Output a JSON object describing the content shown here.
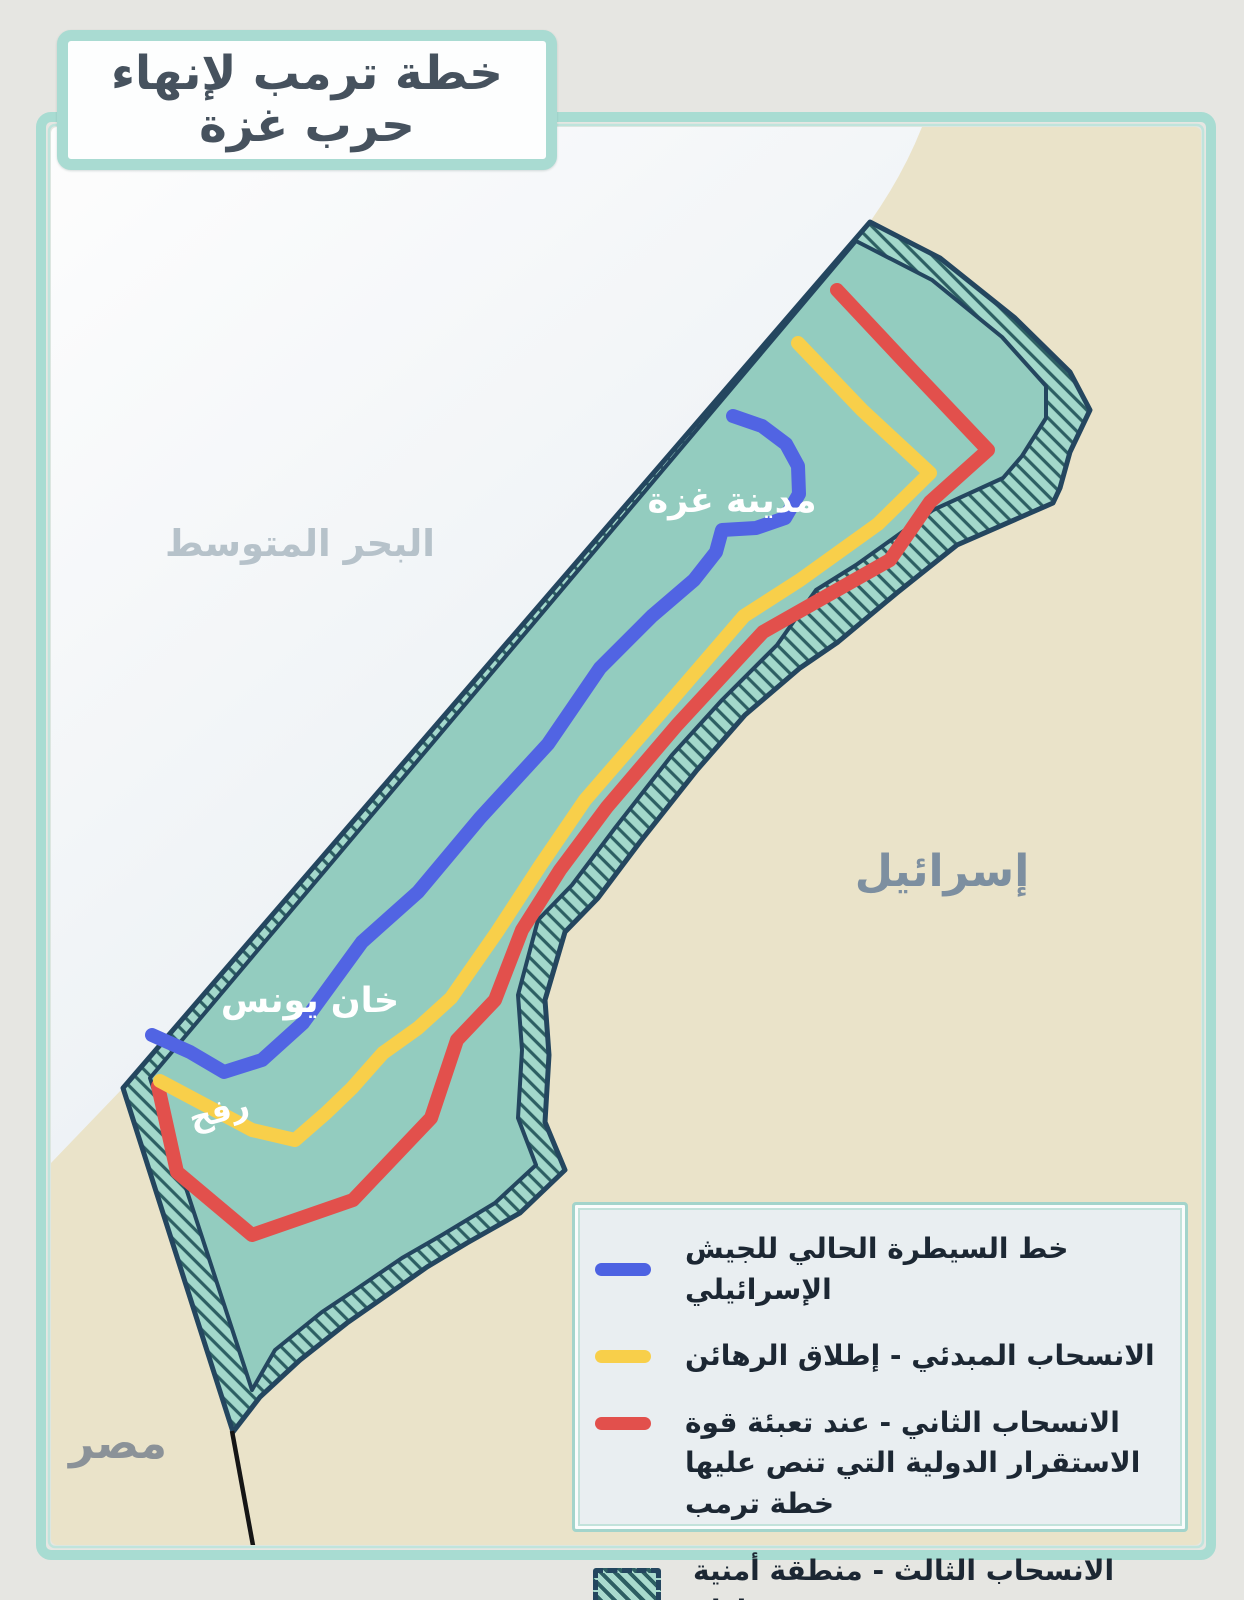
{
  "title": "خطة ترمب لإنهاء حرب غزة",
  "map": {
    "labels": {
      "sea": "البحر المتوسط",
      "israel": "إسرائيل",
      "egypt": "مصر",
      "gaza_city": "مدينة غزة",
      "khan_younis": "خان يونس",
      "rafah": "رفح"
    },
    "colors": {
      "sea": "#f2f6f8",
      "land": "#eae3c9",
      "gaza": "#93ccbf",
      "buffer_fill": "#a3d8cb",
      "border_navy": "#24465f",
      "blue_line": "#5164e3",
      "yellow_line": "#f8cf4a",
      "red_line": "#e2504c"
    }
  },
  "legend": {
    "items": [
      {
        "key": "israeli-control-line",
        "label": "خط السيطرة الحالي للجيش الإسرائيلي"
      },
      {
        "key": "initial-withdrawal-line",
        "label": "الانسحاب المبدئي - إطلاق الرهائن"
      },
      {
        "key": "second-withdrawal-line",
        "label": "الانسحاب الثاني - عند تعبئة قوة الاستقرار الدولية التي تنص عليها خطة ترمب"
      },
      {
        "key": "third-withdrawal-zone",
        "label": "الانسحاب الثالث - منطقة أمنية عازلة"
      }
    ]
  }
}
